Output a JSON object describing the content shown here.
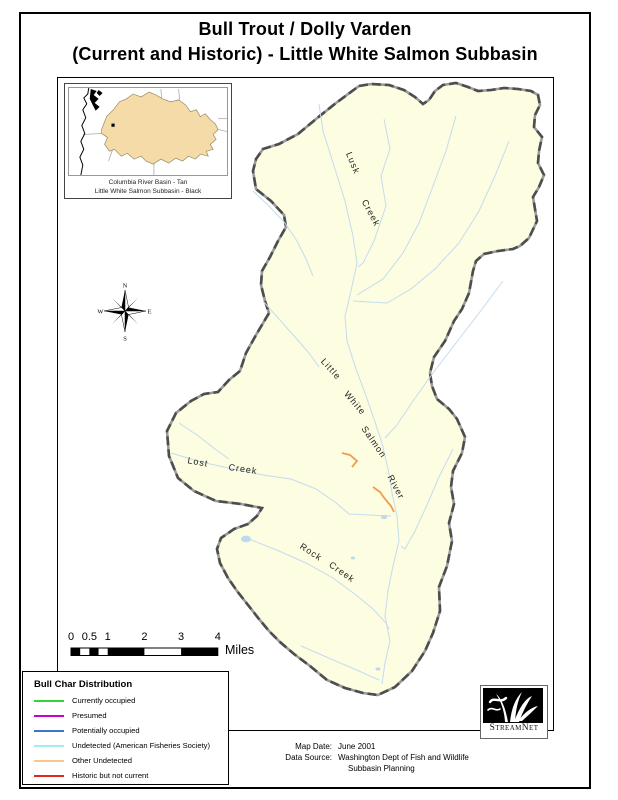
{
  "page": {
    "title_line1": "Bull Trout / Dolly Varden",
    "title_line2": "(Current and Historic) - Little White Salmon Subbasin"
  },
  "inset": {
    "caption_line1": "Columbia River Basin - Tan",
    "caption_line2": "Little White Salmon Subbasin - Black"
  },
  "compass": {
    "north": "N",
    "east": "E",
    "south": "S",
    "west": "W"
  },
  "map": {
    "stream_labels": [
      {
        "text": "Lusk",
        "x": 352,
        "y": 162,
        "rot": 68
      },
      {
        "text": "Creek",
        "x": 370,
        "y": 212,
        "rot": 62
      },
      {
        "text": "Little",
        "x": 330,
        "y": 368,
        "rot": 48
      },
      {
        "text": "White",
        "x": 354,
        "y": 402,
        "rot": 50
      },
      {
        "text": "Salmon",
        "x": 373,
        "y": 441,
        "rot": 55
      },
      {
        "text": "River",
        "x": 395,
        "y": 486,
        "rot": 62
      },
      {
        "text": "Lost",
        "x": 197,
        "y": 461,
        "rot": 10
      },
      {
        "text": "Creek",
        "x": 242,
        "y": 468,
        "rot": 8
      },
      {
        "text": "Rock",
        "x": 310,
        "y": 551,
        "rot": 33
      },
      {
        "text": "Creek",
        "x": 341,
        "y": 571,
        "rot": 35
      }
    ]
  },
  "scalebar": {
    "tick_values": [
      0,
      0.5,
      1,
      2,
      3,
      4
    ],
    "tick_labels": [
      "0",
      "0.5",
      "1",
      "2",
      "3",
      "4"
    ],
    "unit": "Miles"
  },
  "legend": {
    "title": "Bull Char Distribution",
    "items": [
      {
        "label": "Currently occupied",
        "color": "#35D435"
      },
      {
        "label": "Presumed",
        "color": "#CC00CC"
      },
      {
        "label": "Potentially occupied",
        "color": "#3E74C9"
      },
      {
        "label": "Undetected (American Fisheries Society)",
        "color": "#9FEFEF"
      },
      {
        "label": "Other Undetected",
        "color": "#FBC68E"
      },
      {
        "label": "Historic but not current",
        "color": "#DC2A1E"
      }
    ]
  },
  "credits": {
    "map_date_label": "Map Date:",
    "map_date_value": "June 2001",
    "data_source_label": "Data Source:",
    "data_source_value": "Washington Dept of Fish and Wildlife",
    "data_source_value2": "Subbasin Planning"
  },
  "logo": {
    "name": "StreamNet"
  },
  "colors": {
    "subbasin_fill": "#FDFDE2",
    "boundary": "#4D4D4D",
    "stream": "#C3DCEE",
    "orange_segment": "#F49A4C",
    "pond": "#BFD9EE",
    "inset_basin_tan": "#F5DBA7"
  }
}
